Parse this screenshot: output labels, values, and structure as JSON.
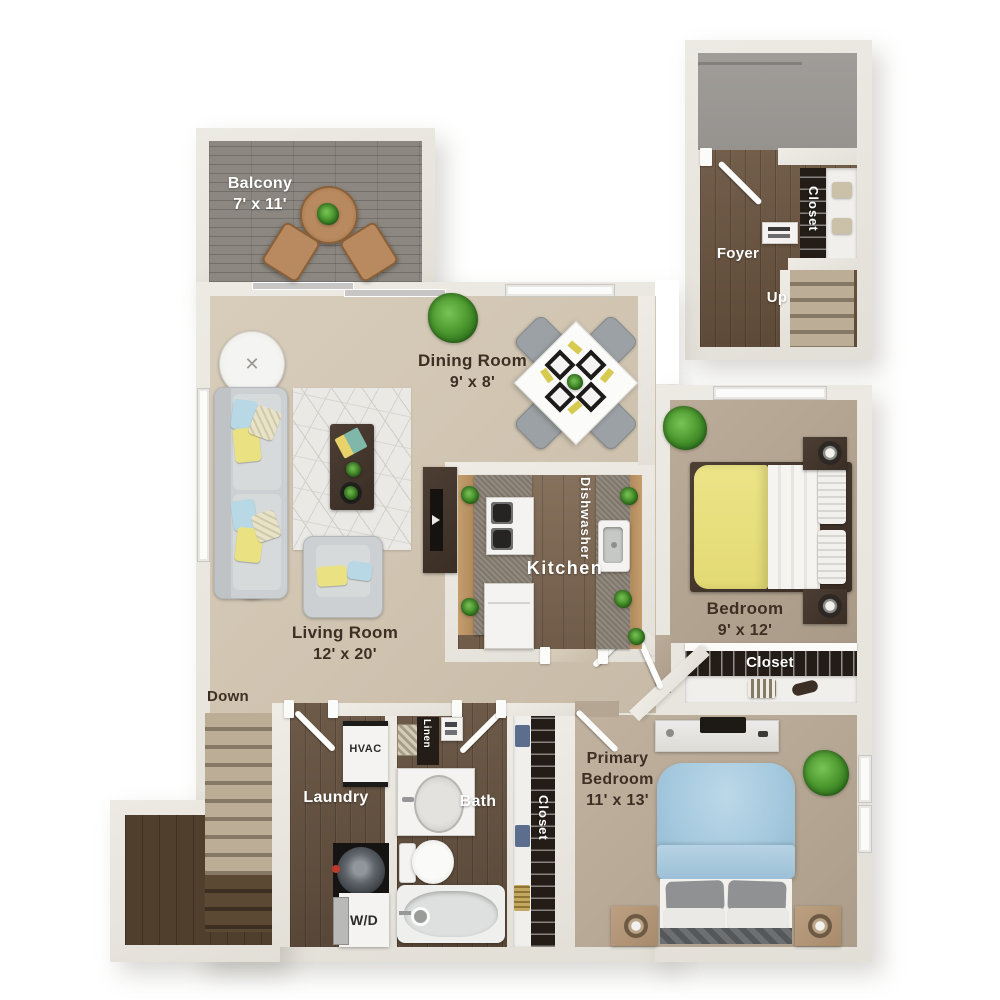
{
  "plan_title": "Two-level apartment floor plan",
  "colors": {
    "wall": "#e8e5de",
    "carpet_light": "#d2c6b3",
    "carpet_dark": "#b3a492",
    "wood_floor": "#64503e",
    "wood_kitchen": "#7c6650",
    "deck_gray": "#8c8781",
    "porch_concrete": "#9b9894",
    "accent_yellow": "#e9e182",
    "accent_blue": "#a9cbdf",
    "granite": "#8a8174",
    "cabinet_tan": "#ba9263",
    "text_dark": "#3d2f23",
    "text_light": "#ffffff",
    "plant_green": "#4d9a30"
  },
  "rooms": {
    "balcony": {
      "name": "Balcony",
      "dims": "7' x 11'"
    },
    "dining_room": {
      "name": "Dining Room",
      "dims": "9' x 8'"
    },
    "living_room": {
      "name": "Living Room",
      "dims": "12' x 20'"
    },
    "kitchen": {
      "name": "Kitchen",
      "dishwasher_label": "Dishwasher"
    },
    "bedroom": {
      "name": "Bedroom",
      "dims": "9' x 12'",
      "closet_label": "Closet"
    },
    "primary_bedroom": {
      "name_line1": "Primary",
      "name_line2": "Bedroom",
      "dims": "11' x 13'",
      "closet_label": "Closet"
    },
    "bath": {
      "name": "Bath",
      "linen_label": "Linen"
    },
    "laundry": {
      "name": "Laundry",
      "hvac_label": "HVAC",
      "washer_dryer_label": "W/D"
    },
    "foyer": {
      "name": "Foyer",
      "stairs_label": "Up",
      "closet_label": "Closet"
    },
    "stairwell": {
      "down_label": "Down"
    }
  }
}
